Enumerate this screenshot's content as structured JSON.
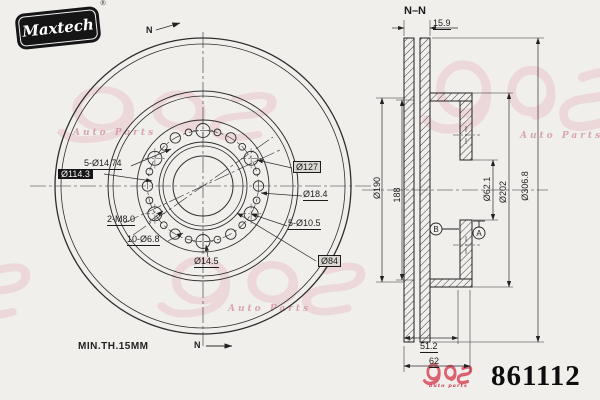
{
  "brand": {
    "name": "Maxtech",
    "reg": "®"
  },
  "watermark": {
    "subtext": "Auto Parts"
  },
  "front_view": {
    "callouts": {
      "lug_holes": "5-Ø14.74",
      "pcd": "Ø114.3",
      "hat_od": "Ø127",
      "hole_184": "Ø18.4",
      "thread_holes": "2-M8.0",
      "holes_105": "5-Ø10.5",
      "holes_68": "10-Ø6.8",
      "hole_145": "Ø14.5",
      "register": "Ø84"
    },
    "min_thickness": "MIN.TH.15MM",
    "section_marker": "N"
  },
  "section_view": {
    "title": "N–N",
    "dimensions": {
      "disc_thickness": "15.9",
      "inner_diameter": "Ø190",
      "vent_diameter": "188",
      "bore": "Ø62.1",
      "hat_diameter": "Ø202",
      "outer_diameter": "Ø306.8",
      "hat_depth": "51.2",
      "overall_height": "62"
    },
    "datums": {
      "a": "A",
      "b": "B"
    }
  },
  "footer": {
    "part_number": "861112",
    "logo_subtext": "auto parts"
  },
  "colors": {
    "background": "#f1efec",
    "line": "#2e2e2e",
    "watermark_pink": "#e7c3cb",
    "logo_red": "#d84a5c",
    "brand_black": "#151515"
  }
}
